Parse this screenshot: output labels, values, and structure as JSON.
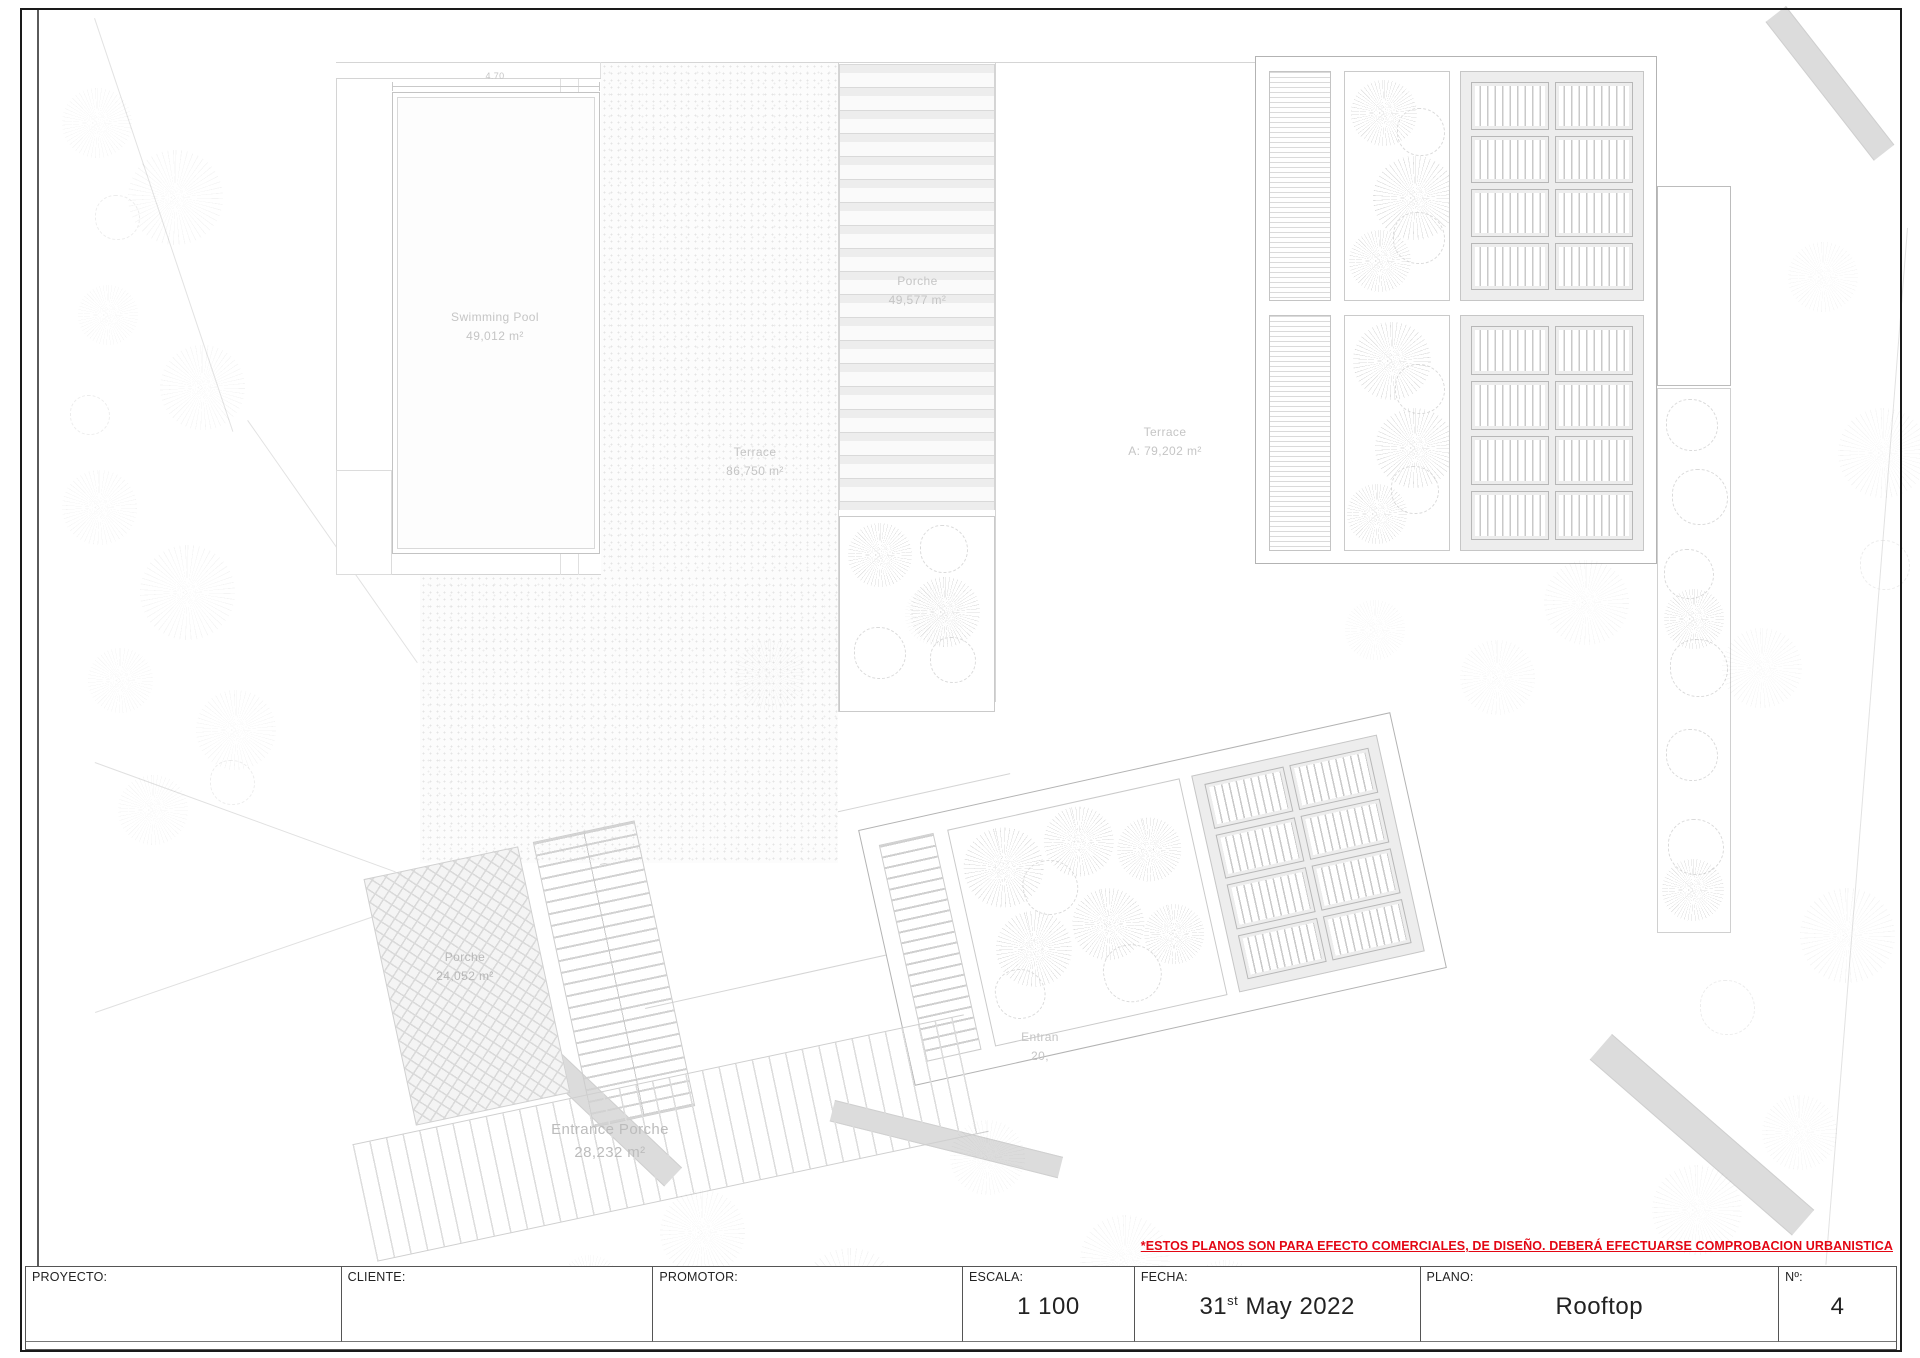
{
  "sheet": {
    "disclaimer": "*ESTOS PLANOS SON PARA EFECTO COMERCIALES, DE DISEÑO. DEBERÁ EFECTUARSE COMPROBACION URBANISTICA"
  },
  "colors": {
    "disclaimer_red": "#e30613",
    "plan_line_gray": "#d5d5d5",
    "panel_fill_gray": "#ededed"
  },
  "plan": {
    "pool": {
      "name": "Swimming Pool",
      "area": "49,012 m²",
      "dim": "4.70"
    },
    "terrace_main": {
      "name": "Terrace",
      "area": "86,750 m²"
    },
    "porche_top": {
      "name": "Porche",
      "area": "49,577 m²"
    },
    "terrace_a": {
      "name": "Terrace",
      "area": "A: 79,202 m²"
    },
    "porche_entry": {
      "name": "Porche",
      "area": "24,052 m²"
    },
    "entrance_porche": {
      "name": "Entrance Porche",
      "area": "28,232 m²"
    },
    "entrance_partial": {
      "name": "Entran",
      "area": "20,"
    }
  },
  "title_block": {
    "cells": [
      {
        "label": "PROYECTO:",
        "value": ""
      },
      {
        "label": "CLIENTE:",
        "value": ""
      },
      {
        "label": "PROMOTOR:",
        "value": ""
      },
      {
        "label": "ESCALA:",
        "value": "1 100"
      },
      {
        "label": "FECHA:",
        "value_day": "31",
        "value_suffix": "st",
        "value_rest": "May 2022"
      },
      {
        "label": "PLANO:",
        "value": "Rooftop"
      },
      {
        "label": "Nº:",
        "value": "4"
      }
    ]
  }
}
